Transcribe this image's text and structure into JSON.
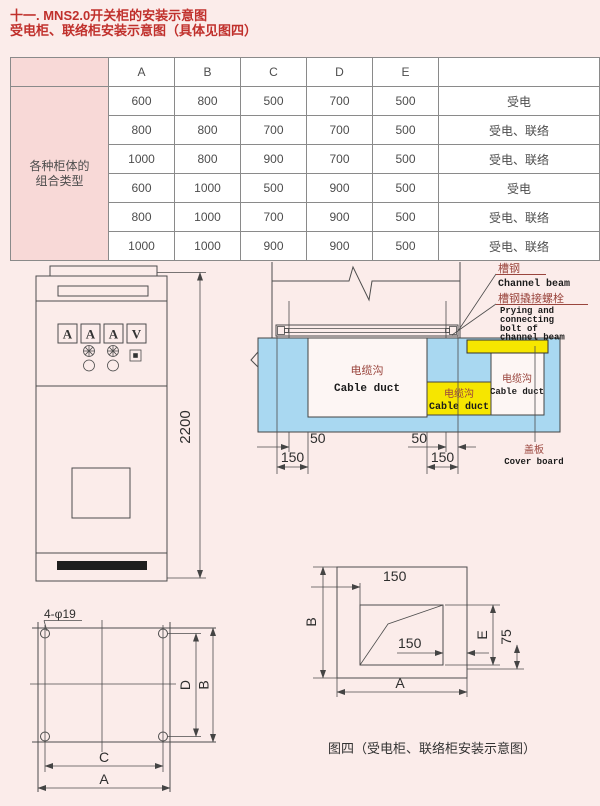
{
  "title": {
    "line1": "十一. MNS2.0开关柜的安装示意图",
    "line2": "受电柜、联络柜安装示意图（具体见图四）"
  },
  "table": {
    "columns": [
      "A",
      "B",
      "C",
      "D",
      "E"
    ],
    "row_header": "各种柜体的组合类型",
    "rows": [
      [
        "600",
        "800",
        "500",
        "700",
        "500",
        "受电"
      ],
      [
        "800",
        "800",
        "700",
        "700",
        "500",
        "受电、联络"
      ],
      [
        "1000",
        "800",
        "900",
        "700",
        "500",
        "受电、联络"
      ],
      [
        "600",
        "1000",
        "500",
        "900",
        "500",
        "受电"
      ],
      [
        "800",
        "1000",
        "700",
        "900",
        "500",
        "受电、联络"
      ],
      [
        "1000",
        "1000",
        "900",
        "900",
        "500",
        "受电、联络"
      ]
    ]
  },
  "cabinet": {
    "meters": [
      "A",
      "A",
      "A",
      "V"
    ],
    "height": "2200"
  },
  "section": {
    "channel_cn": "槽钢",
    "channel_en": "Channel beam",
    "bolt_cn": "槽钢撬接螺栓",
    "bolt_en1": "Prying and",
    "bolt_en2": "connecting",
    "bolt_en3": "bolt of",
    "bolt_en4": "channel beam",
    "duct_cn": "电缆沟",
    "duct_en": "Cable duct",
    "cover_cn": "盖板",
    "cover_en": "Cover board",
    "dim_50": "50",
    "dim_150": "150"
  },
  "flange": {
    "holes": "4-φ19",
    "dim_c": "C",
    "dim_a": "A",
    "dim_d": "D",
    "dim_b": "B"
  },
  "fig4": {
    "dim_150": "150",
    "dim_b": "B",
    "dim_e": "E",
    "dim_75": "75",
    "dim_a": "A",
    "caption": "图四（受电柜、联络柜安装示意图）"
  },
  "colors": {
    "accent_red": "#c0302c",
    "table_pink": "#f8d9d7",
    "duct_blue": "#a9d8f1",
    "duct_yellow": "#f6e600"
  }
}
